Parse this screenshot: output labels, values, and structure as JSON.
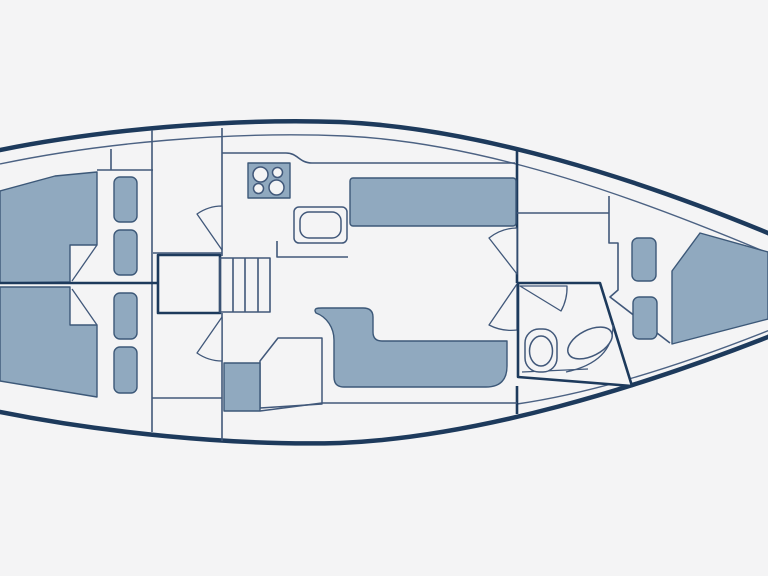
{
  "diagram": {
    "label": "Sailboat interior floor plan, top view, bow pointing right",
    "type": "yacht-floor-plan",
    "orientation": "bow-right",
    "rooms": [
      {
        "id": "aft-cabin-port",
        "label": "Aft cabin (port)",
        "features": [
          "double berth",
          "2 berth cushions",
          "swing door"
        ]
      },
      {
        "id": "aft-cabin-starboard",
        "label": "Aft cabin (starboard)",
        "features": [
          "double berth",
          "2 berth cushions",
          "swing door"
        ]
      },
      {
        "id": "companionway",
        "label": "Companionway",
        "features": [
          "engine box",
          "4-step ladder"
        ]
      },
      {
        "id": "galley",
        "label": "Galley",
        "features": [
          "4-burner stove",
          "sink",
          "counter"
        ]
      },
      {
        "id": "salon",
        "label": "Salon",
        "features": [
          "straight settee",
          "L-shaped sofa",
          "seat cushion",
          "cabinet"
        ]
      },
      {
        "id": "head",
        "label": "Head (bathroom)",
        "features": [
          "toilet",
          "washbasin",
          "swing door"
        ]
      },
      {
        "id": "forward-cabin",
        "label": "Forward cabin",
        "features": [
          "V-berth",
          "2 berth cushions",
          "shelf",
          "double swing doors"
        ]
      }
    ],
    "counts": {
      "stove_burners": 4,
      "ladder_steps": 4,
      "aft_cushions": 4,
      "forward_cushions": 2
    }
  },
  "colors": {
    "bg": "#f4f4f5",
    "line-heavy": "#1d3a5c",
    "line-wall": "#41587a",
    "line-inner": "#4c6283",
    "furniture": "#90a9bf",
    "line-furn": "#3c5878"
  }
}
